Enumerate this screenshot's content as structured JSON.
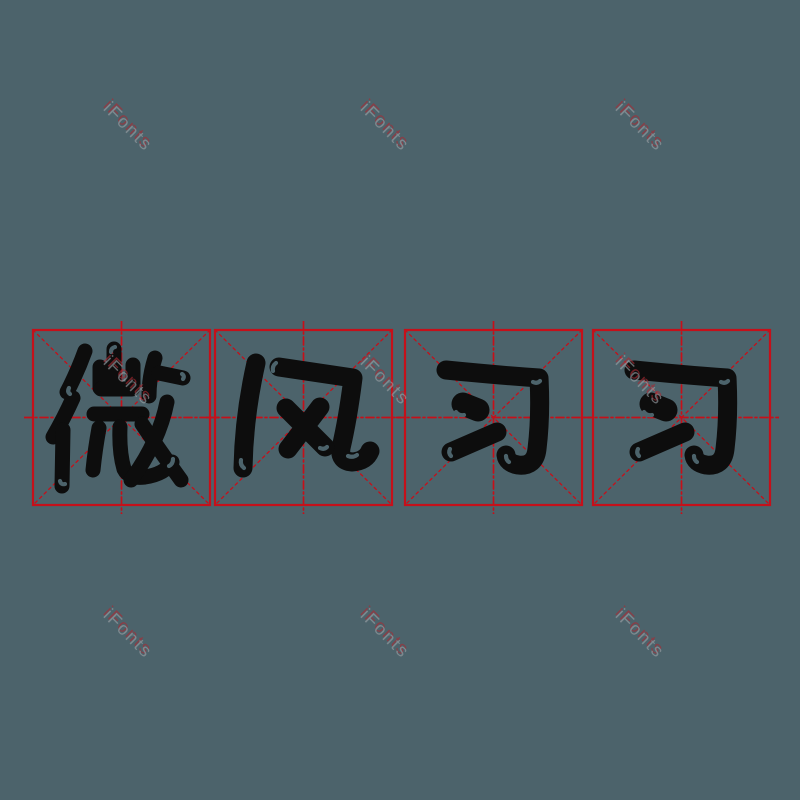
{
  "canvas": {
    "width": 800,
    "height": 800,
    "background_color": "#4c636b"
  },
  "phrase": {
    "text": "微风习习"
  },
  "practice_grid": {
    "style": "mizige",
    "line_color": "#c5101a",
    "border_width": 2.2,
    "glyph_color": "#0d0d0d",
    "top": 330,
    "cell_width": 177,
    "cell_height": 175,
    "overhang": 9,
    "cells": [
      {
        "char": "微",
        "left": 33
      },
      {
        "char": "风",
        "left": 215
      },
      {
        "char": "习",
        "left": 405
      },
      {
        "char": "习",
        "left": 593
      }
    ]
  },
  "glyphs": {
    "微": {
      "stroke_width": 15,
      "strokes": [
        {
          "d": "M52 21 Q44 43 34 62"
        },
        {
          "d": "M40 68 Q31 88 20 107"
        },
        {
          "d": "M30 100 L29 156"
        },
        {
          "d": "M67 37 L67 58"
        },
        {
          "d": "M81 19 L81 58"
        },
        {
          "d": "M100 35 L100 58"
        },
        {
          "d": "M68 59 L99 59"
        },
        {
          "d": "M61 84 L109 84"
        },
        {
          "d": "M66 98 Q62 120 60 140"
        },
        {
          "d": "M87 97 Q86 122 91 139 Q96 149 112 147 Q132 144 139 132"
        },
        {
          "d": "M122 28 Q116 47 116 66"
        },
        {
          "d": "M126 43 L150 48"
        },
        {
          "d": "M134 72 Q126 112 98 150"
        },
        {
          "d": "M109 94 Q125 118 148 150"
        }
      ],
      "glints": [
        "M78 22 Q78 18 82 17",
        "M36 58 Q34 62 37 64",
        "M149 44 Q152 46 150 49",
        "M136 136 Q140 134 140 129",
        "M27 151 Q28 155 32 154"
      ]
    },
    "风": {
      "stroke_width": 19,
      "strokes": [
        {
          "d": "M41 33 Q29 86 28 138"
        },
        {
          "d": "M64 37 Q104 43 138 48 Q133 88 126 118 Q124 131 137 132 Q151 131 155 121"
        },
        {
          "d": "M71 78 L110 117"
        },
        {
          "d": "M105 77 L73 119"
        }
      ],
      "glints": [
        "M133 126 Q138 128 142 125",
        "M26 130 Q25 135 29 138",
        "M58 41 Q57 36 61 33",
        "M105 118 Q109 120 112 117"
      ]
    },
    "习": {
      "stroke_width": 19,
      "strokes": [
        {
          "d": "M41 40 Q91 45 134 48 Q136 86 132 119 Q130 137 113 135 Q102 133 101 125"
        },
        {
          "d": "M58 74 L73 80",
          "w": 23
        },
        {
          "d": "M46 122 L92 102"
        }
      ],
      "glints": [
        "M128 52 Q132 54 135 51",
        "M51 82 Q54 86 59 85",
        "M104 132 Q101 130 101 126",
        "M45 119 Q43 123 46 126"
      ]
    }
  },
  "watermark": {
    "text": "iFonts",
    "color": "#9ba1a6",
    "accent_color": "#aa2a33",
    "opacity": 0.62,
    "rotation_deg": 45,
    "positions": [
      {
        "x": 128,
        "y": 127
      },
      {
        "x": 385,
        "y": 127
      },
      {
        "x": 640,
        "y": 127
      },
      {
        "x": 128,
        "y": 381
      },
      {
        "x": 385,
        "y": 381
      },
      {
        "x": 640,
        "y": 381
      },
      {
        "x": 128,
        "y": 634
      },
      {
        "x": 385,
        "y": 634
      },
      {
        "x": 640,
        "y": 634
      }
    ]
  }
}
